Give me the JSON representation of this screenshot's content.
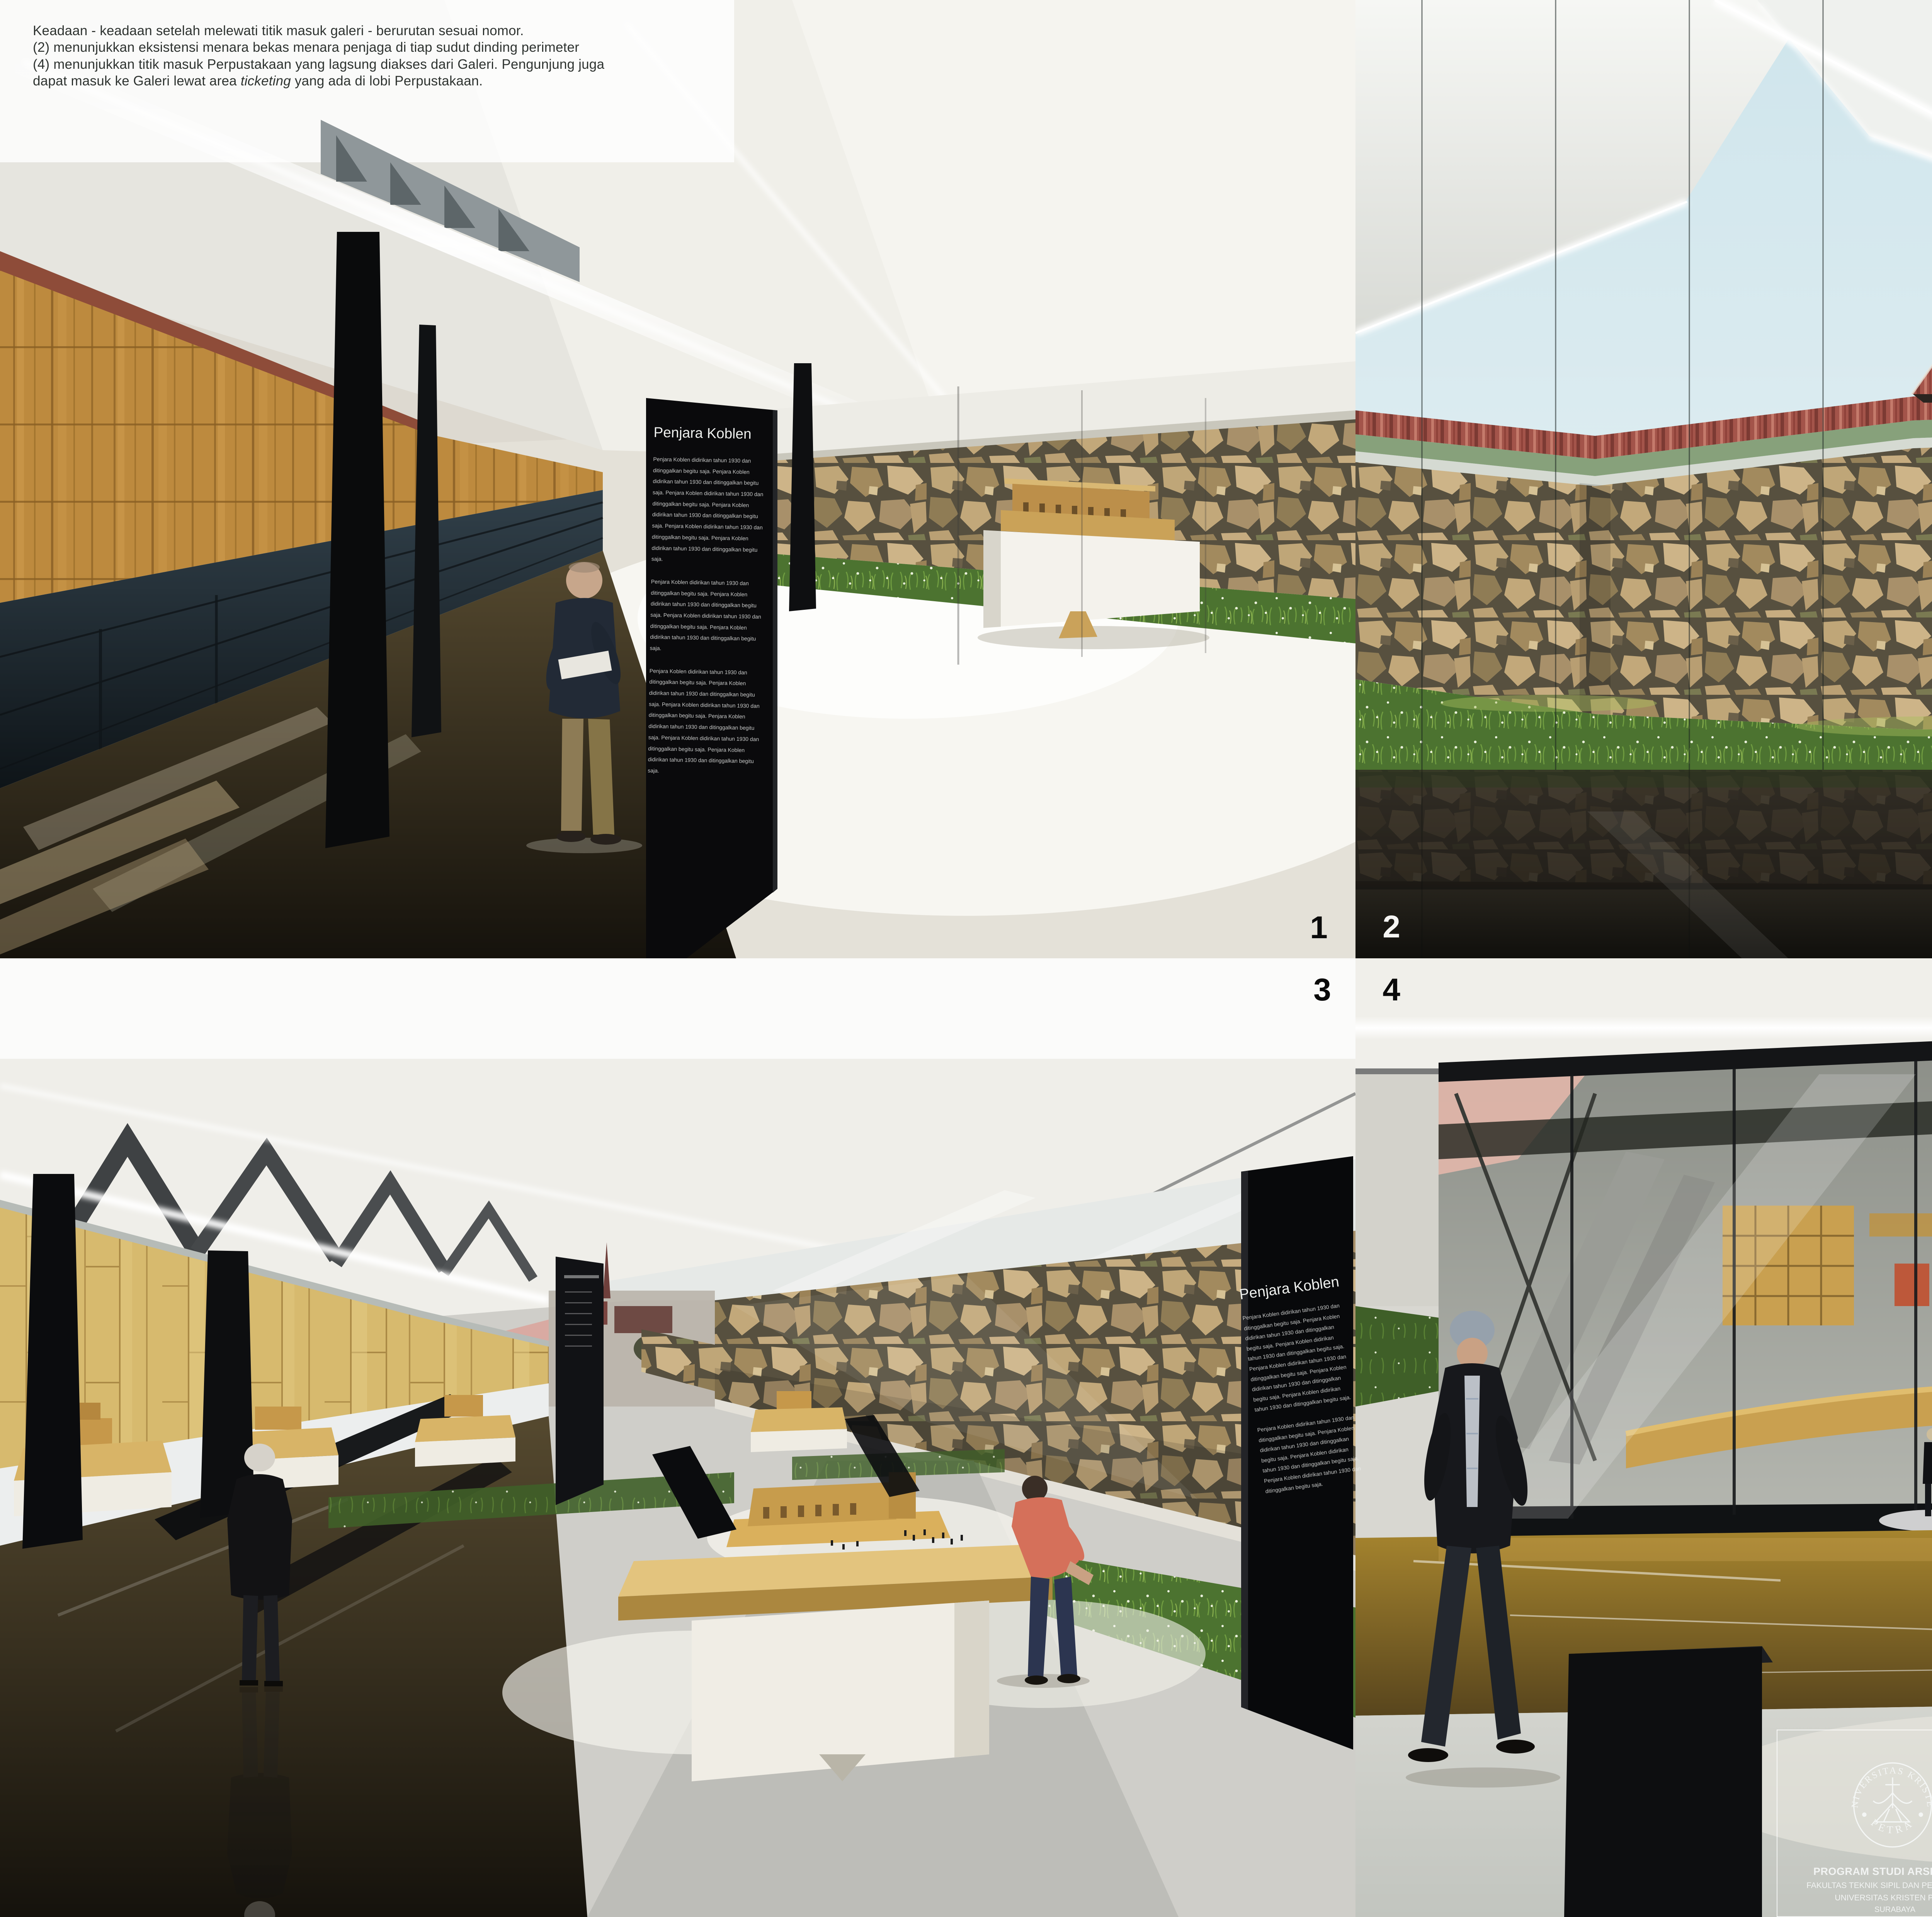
{
  "description": {
    "line1": "Keadaan - keadaan setelah melewati titik masuk galeri - berurutan sesuai nomor.",
    "line2": "(2) menunjukkan eksistensi menara bekas menara penjaga di tiap sudut dinding perimeter",
    "line3": "(4) menunjukkan titik masuk Perpustakaan yang lagsung diakses dari Galeri. Pengunjung juga",
    "line4_pre": "dapat masuk ke Galeri lewat area ",
    "line4_italic": "ticketing",
    "line4_post": " yang ada di lobi Perpustakaan."
  },
  "view_numbers": {
    "v1": "1",
    "v2": "2",
    "v3": "3",
    "v4": "4"
  },
  "exhibit_panel": {
    "title": "Penjara Koblen",
    "body_1": "Penjara Koblen didirikan tahun 1930 dan ditinggalkan begitu saja. Penjara Koblen didirikan tahun 1930 dan ditinggalkan begitu saja. Penjara Koblen didirikan tahun 1930 dan ditinggalkan begitu saja. Penjara Koblen didirikan tahun 1930 dan ditinggalkan begitu saja. Penjara Koblen didirikan tahun 1930 dan ditinggalkan begitu saja. Penjara Koblen didirikan tahun 1930 dan ditinggalkan begitu saja.",
    "body_2": "Penjara Koblen didirikan tahun 1930 dan ditinggalkan begitu saja. Penjara Koblen didirikan tahun 1930 dan ditinggalkan begitu saja. Penjara Koblen didirikan tahun 1930 dan ditinggalkan begitu saja. Penjara Koblen didirikan tahun 1930 dan ditinggalkan begitu saja."
  },
  "title_block": {
    "course": "TUGAS AKHIR - SEMESTER GENAP 2015/2016",
    "labels": {
      "judul_tugas": "JUDUL TUGAS",
      "judul_gambar": "JUDUL GAMBAR",
      "skala": "SKALA",
      "nama": "NAMA",
      "nrp": "NRP",
      "kelompok": "KELOMPOK",
      "lembar": "LEMBAR",
      "jumlah": "JUMLAH",
      "mentor_utama": "MENTOR UTAMA",
      "mentor_pendamping": "MENTOR PENDAMPING"
    },
    "judul_tugas_value": "Galeri Cagar Budaya di Koblen",
    "judul_gambar_value": "PERSPEKTIF",
    "nama_value": "YOHANES RICHO WIRAWAN",
    "nrp_value": "22412006",
    "kelompok_value": "6",
    "mentor_utama_value": "C.E. MEDIASTIKA, S.T., Ph.D.",
    "mentor_pendamping_values": [
      "IR. IRWAN SANTOSO, M.T.",
      "IR. J. LUKITO KARTONO, M.A. (†)",
      "GUNAWAN TANUWIDJAJA, S.T.,M.Sc.",
      "LUCIANA KRISTANTO, S.T., M.T."
    ],
    "institution": {
      "program": "PROGRAM STUDI ARSITEKTUR",
      "fakultas": "FAKULTAS TEKNIK SIPIL DAN PERENCANAAN",
      "universitas": "UNIVERSITAS KRISTEN PETRA",
      "kota": "SURABAYA"
    },
    "logo": {
      "top_text": "UNIVERSITAS KRISTEN",
      "bottom_text": "PETRA"
    }
  },
  "colors": {
    "stone": "#b99f72",
    "grass": "#4c7330",
    "wood_wall": "#bd8a3e",
    "timber_wall": "#d7ba6e",
    "roof_tile_red": "#a3544a",
    "panel_black": "#0a0a0c",
    "sky": "#cfe5ec",
    "canopy_white": "#f2f3f0",
    "dark_floor": "#15120c"
  }
}
